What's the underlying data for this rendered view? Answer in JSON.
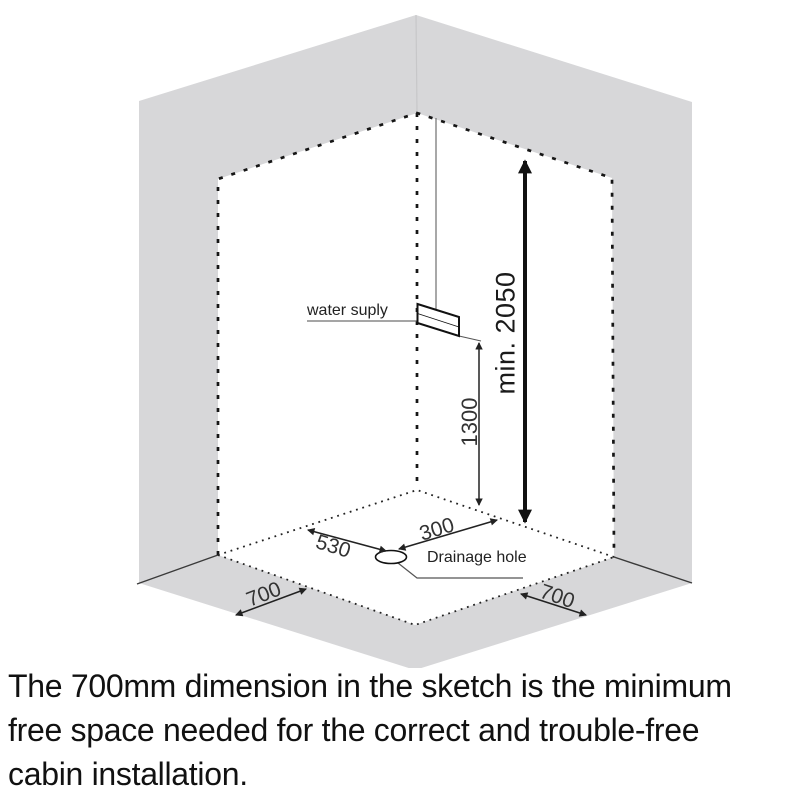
{
  "diagram": {
    "water_supply_label": "water suply",
    "drainage_label": "Drainage hole",
    "dim_min_height": "min. 2050",
    "dim_supply_height": "1300",
    "dim_drain_right": "300",
    "dim_drain_left": "530",
    "dim_margin_left": "700",
    "dim_margin_right": "700",
    "colors": {
      "wall_gray": "#d7d7d9",
      "line_black": "#1c1c1c",
      "leader_gray": "#6f6f6f"
    }
  },
  "caption": {
    "lines": [
      "The 700mm dimension in the sketch is the minimum",
      "free space needed for the correct and trouble-free",
      "cabin installation."
    ]
  }
}
